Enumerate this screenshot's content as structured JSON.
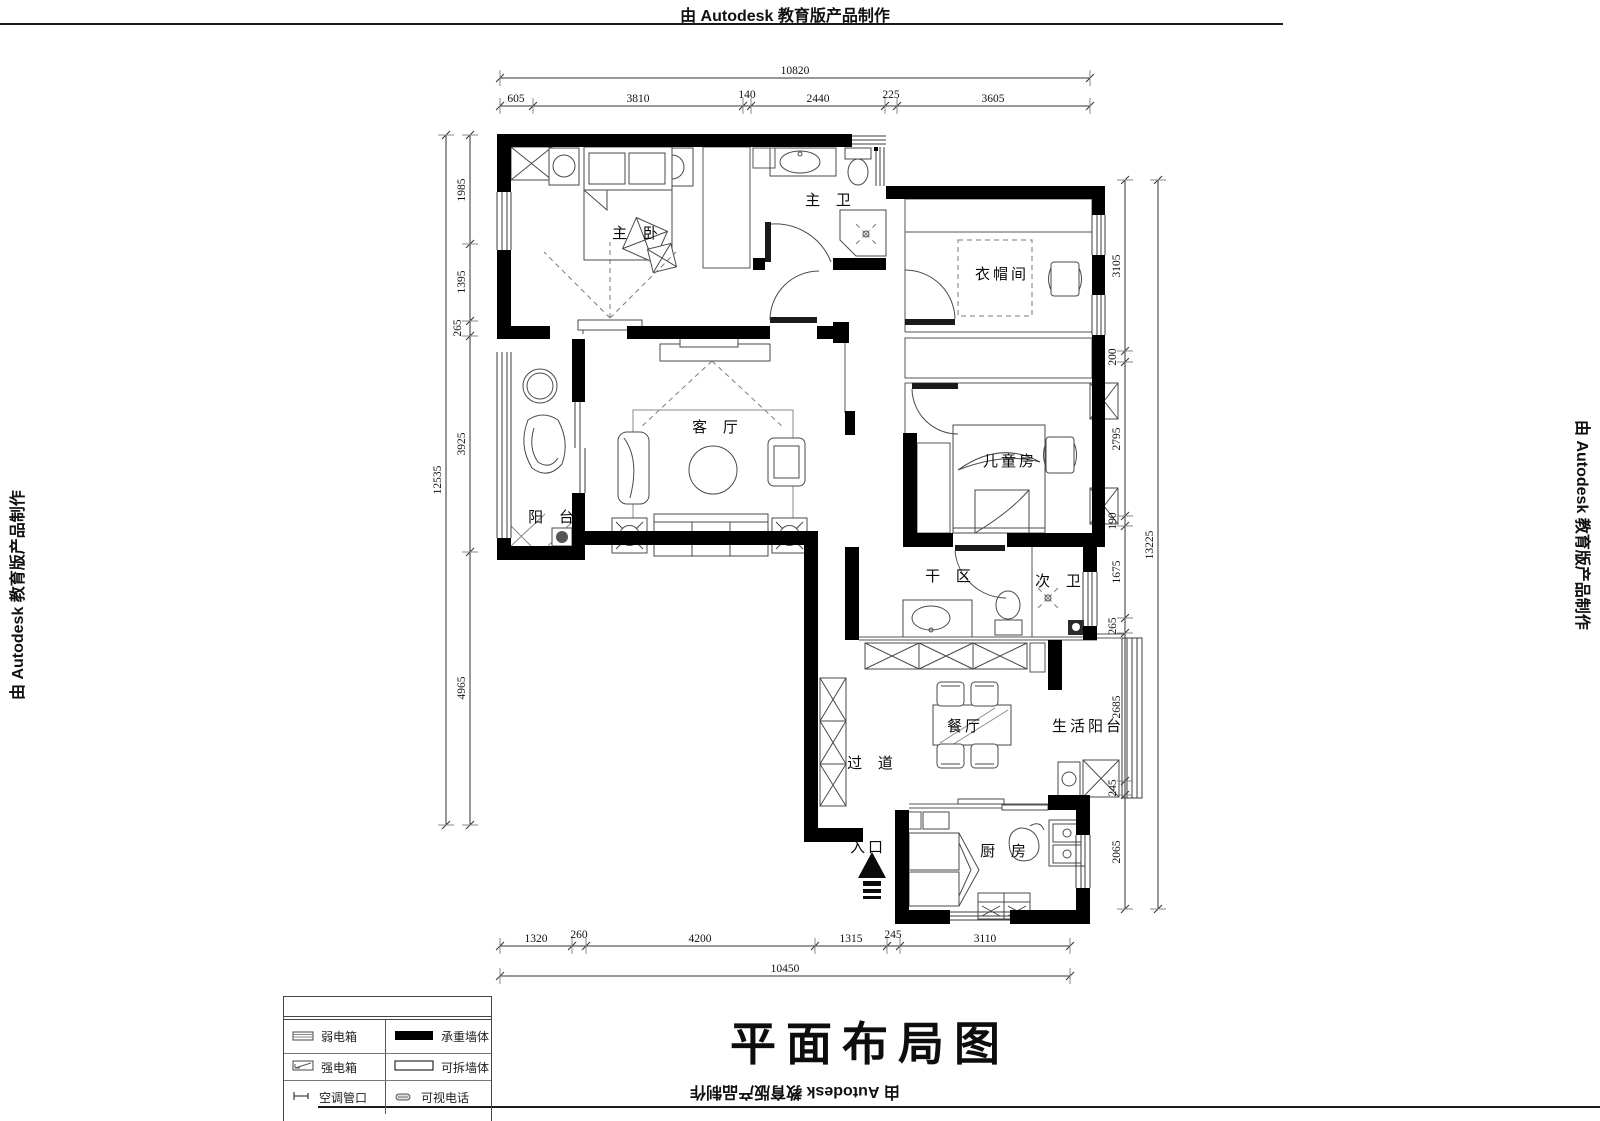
{
  "watermark": {
    "text": "由 Autodesk 教育版产品制作"
  },
  "title": "平面布局图",
  "rooms": {
    "master_bedroom": "主 卧",
    "master_bath": "主 卫",
    "cloakroom": "衣帽间",
    "kids_room": "儿童房",
    "living_room": "客 厅",
    "balcony": "阳 台",
    "dry_area": "干 区",
    "second_bath": "次 卫",
    "dining_room": "餐厅",
    "service_balcony": "生活阳台",
    "hallway": "过 道",
    "entrance": "入口",
    "kitchen": "厨 房"
  },
  "legend": {
    "rows": [
      {
        "left": "弱电箱",
        "right": "承重墙体"
      },
      {
        "left": "强电箱",
        "right": "可拆墙体"
      },
      {
        "left": "空调管口",
        "right": "可视电话"
      }
    ]
  },
  "dimensions": {
    "top": {
      "overall": "10820",
      "segments": [
        "605",
        "3810",
        "140",
        "2440",
        "225",
        "3605"
      ]
    },
    "bottom": {
      "overall": "10450",
      "segments": [
        "1320",
        "260",
        "4200",
        "1315",
        "245",
        "3110"
      ]
    },
    "left": {
      "overall": "12535",
      "segments": [
        "1985",
        "1395",
        "265",
        "3925",
        "4965"
      ]
    },
    "right": {
      "overall": "13225",
      "segments": [
        "3105",
        "200",
        "2795",
        "190",
        "1675",
        "265",
        "2685",
        "245",
        "2065"
      ]
    }
  }
}
